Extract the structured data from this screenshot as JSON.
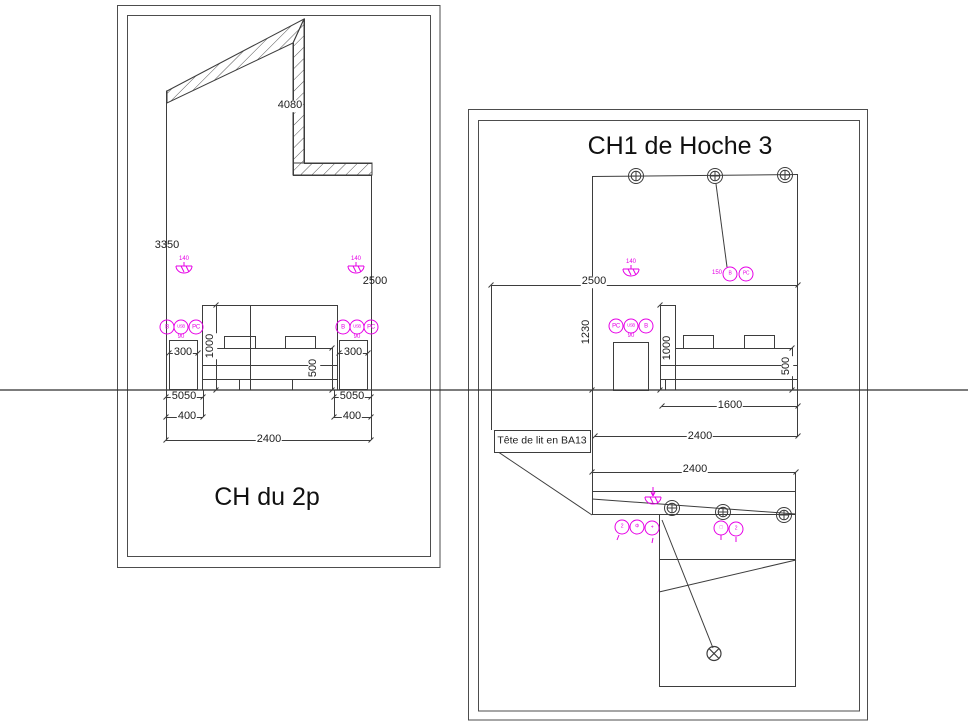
{
  "colors": {
    "accent": "#e600e6",
    "line": "#3d3d3d"
  },
  "left": {
    "title": "CH du 2p",
    "dim_4080": "4080",
    "dim_3350": "3350",
    "dim_2500": "2500",
    "dim_1000": "1000",
    "dim_500": "500",
    "dim_300_left": "300",
    "dim_300_right": "300",
    "dim_5050_left": "5050",
    "dim_5050_right": "5050",
    "dim_400_left": "400",
    "dim_400_right": "400",
    "dim_2400": "2400",
    "lamp_left_height": "140",
    "lamp_right_height": "140",
    "sockets_left": {
      "c1": "B",
      "c2": "USB",
      "c3": "PC",
      "height": "90"
    },
    "sockets_right": {
      "c1": "B",
      "c2": "USB",
      "c3": "PC",
      "height": "90"
    }
  },
  "right": {
    "title": "CH1 de Hoche 3",
    "dim_2500": "2500",
    "dim_1230": "1230",
    "lamp_height": "140",
    "bed_switch": {
      "height": "150",
      "c1": "B",
      "c2": "PC"
    },
    "sockets": {
      "c1": "PC",
      "c2": "USB",
      "c3": "B",
      "height": "90"
    },
    "dim_1000": "1000",
    "dim_500": "500",
    "dim_1600": "1600",
    "dim_2400_elevation": "2400",
    "dim_2400_plan": "2400",
    "note": "Tête de lit en BA13",
    "plan_switches": {
      "c1": "2",
      "c2": "Φ",
      "c3": "+"
    },
    "plan_sockets": {
      "c1": "□",
      "c2": "2"
    }
  }
}
